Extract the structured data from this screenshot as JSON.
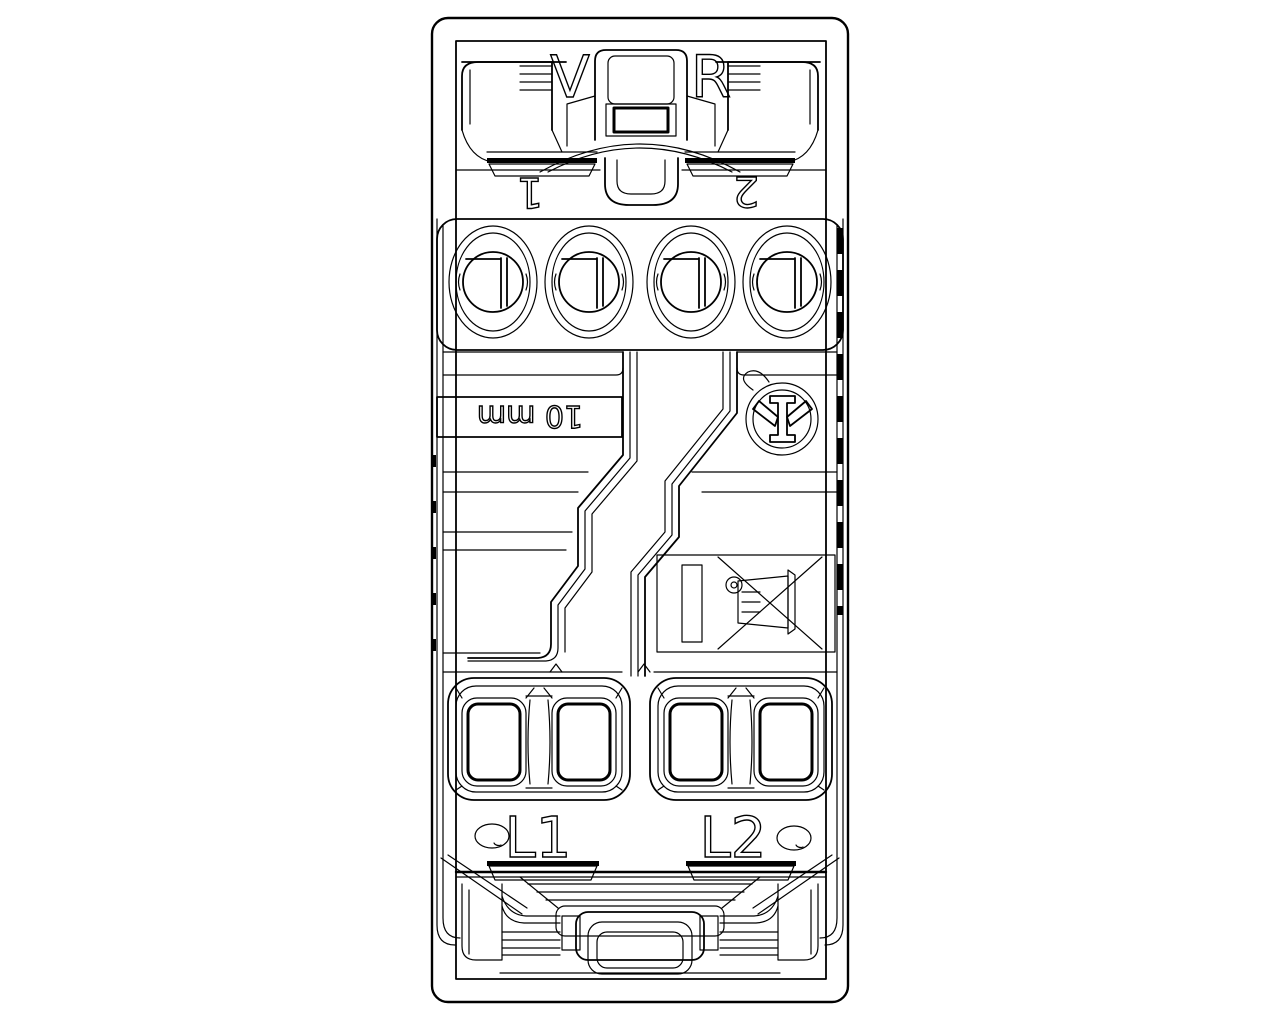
{
  "meta": {
    "description": "Technical CAD line drawing of a modular two-gang electrical switch mechanism, rear view",
    "background_color": "#ffffff",
    "line_color": "#000000"
  },
  "labels": {
    "brand_left": "V",
    "brand_right": "R",
    "terminal_number_left": "1",
    "terminal_number_right": "2",
    "strip_length": "10 mm",
    "load_left": "L1",
    "load_right": "L2"
  },
  "icons": [
    {
      "name": "imq-certification-mark",
      "description": "circular IMQ approval mark, printed rotated 180 degrees"
    },
    {
      "name": "weee-crossed-out-bin-icon",
      "description": "crossed-out wheelie bin with solid bar, printed rotated 90 degrees"
    }
  ]
}
